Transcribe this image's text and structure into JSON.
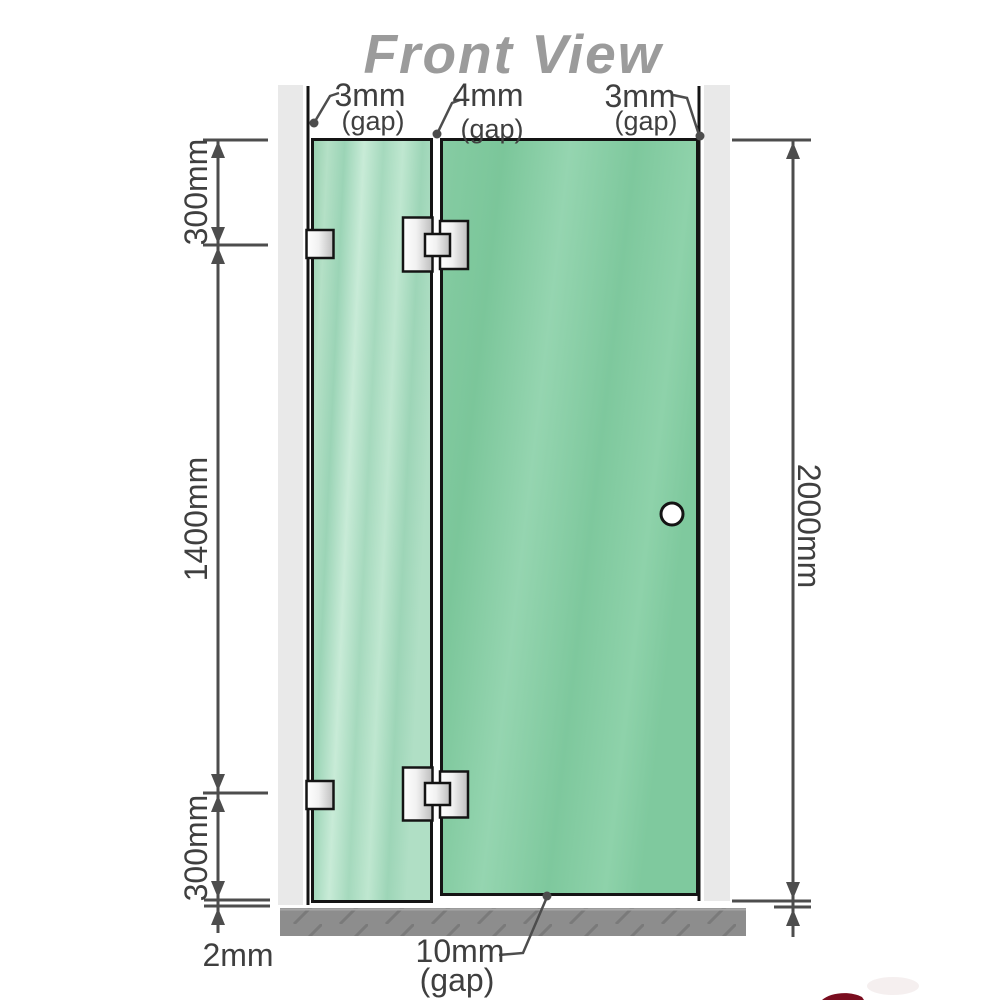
{
  "title": "Front View",
  "dims": {
    "gap_top_left": {
      "value": "3mm",
      "unit": "(gap)"
    },
    "gap_top_mid": {
      "value": "4mm",
      "unit": "(gap)"
    },
    "gap_top_right": {
      "value": "3mm",
      "unit": "(gap)"
    },
    "segment_top": "300mm",
    "segment_middle": "1400mm",
    "segment_bottom": "300mm",
    "floor_gap_fixed_panel": "2mm",
    "overall_height": "2000mm",
    "gap_bottom_door": {
      "value": "10mm",
      "unit": "(gap)"
    }
  },
  "colors": {
    "glass_fixed_panel": "#a5d7b9",
    "glass_door_panel": "#7dc8a0",
    "wall": "#e9e9e9",
    "floor": "#8d8d8d",
    "floor_hatch": "#7a7a7a",
    "dimension_line": "#4d4d4d",
    "title_text": "#9b9b9b",
    "label_text": "#3f3f3f",
    "hardware_metal": "#e0e0e0",
    "red_watermark": "#7a0d1f"
  }
}
